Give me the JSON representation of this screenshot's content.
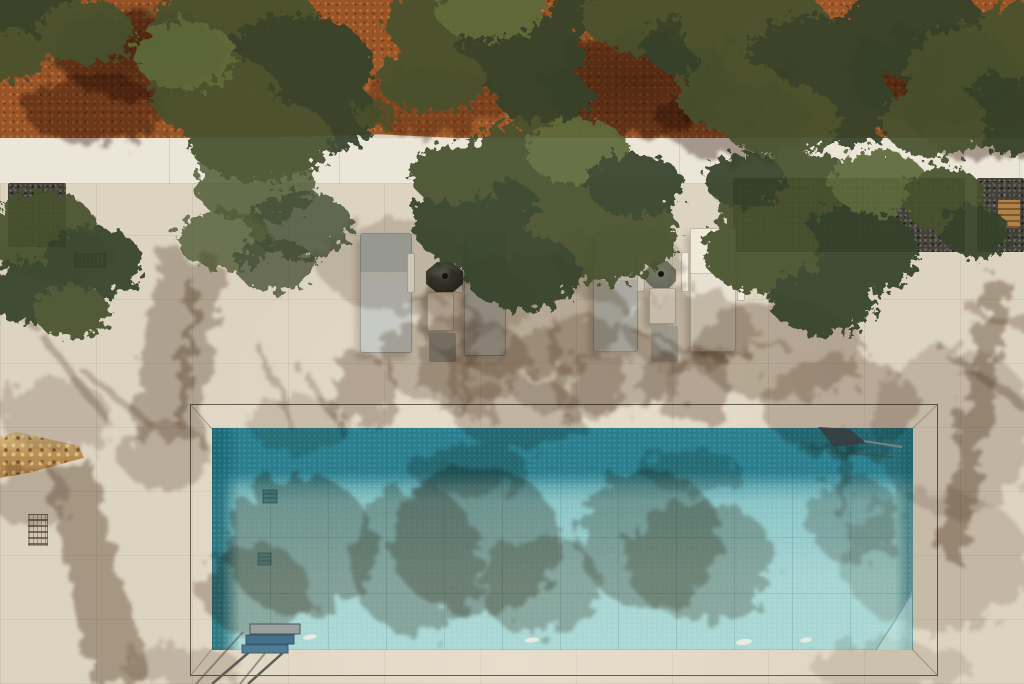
{
  "scene": {
    "type": "aerial-photograph",
    "setting": "Overhead drone view of a villa stone terrace with a rectangular swimming pool, a row of sun loungers under olive trees, and terracotta olive-grove earth beyond a white boundary wall",
    "lighting": "bright sun, tree shadows cast down-left across pale pavers and pool water"
  },
  "palette": {
    "earth": "#9a5426",
    "earth_dark": "#6f3a19",
    "foliage": "#46512d",
    "foliage_dark": "#36422a",
    "foliage_light": "#5d6a3a",
    "wall": "#ece6d9",
    "patio": "#ddd3c1",
    "patio_bright": "#e9e0cd",
    "shadow": "#5f4833",
    "shadow_deep": "#402512",
    "gravel": "#44413a",
    "gravel_light": "#6e6a5e",
    "stone": "#b58a50",
    "stone_light": "#dcbf86",
    "pool_deep": "#2a7e8e",
    "pool_mid": "#8fc7c8",
    "pool_light": "#abd8d4",
    "frame": "#4a4236",
    "lounger_gray": "#c6c9c4",
    "lounger_head": "#b0b3ae",
    "lounger_light": "#d6d3c9",
    "lounger_cream": "#e7e1d1",
    "table": "#ece5d6",
    "tray": "#efeadd",
    "base_dark": "#4a4e43",
    "base_light": "#787d6c",
    "pad_gray": "#a3a59f",
    "ladder_blue": "#44708e",
    "metal": "#5a5c58",
    "glint": "#f3efe6",
    "tan_box": "#b08148"
  },
  "objects": {
    "olive_trees": 9,
    "sun_loungers": 4,
    "umbrella_bases": 2,
    "side_tables": 2,
    "gravel_planting_beds": 3,
    "pool": {
      "shape": "rectangle",
      "features": [
        "tiled floor",
        "underwater lights",
        "floor drains",
        "steps ladder",
        "skimmer pole at top-right corner"
      ]
    },
    "underwater_lights": 4,
    "floor_drains": 2,
    "vents_grates": 2,
    "rubble_stone_wall": 1
  }
}
